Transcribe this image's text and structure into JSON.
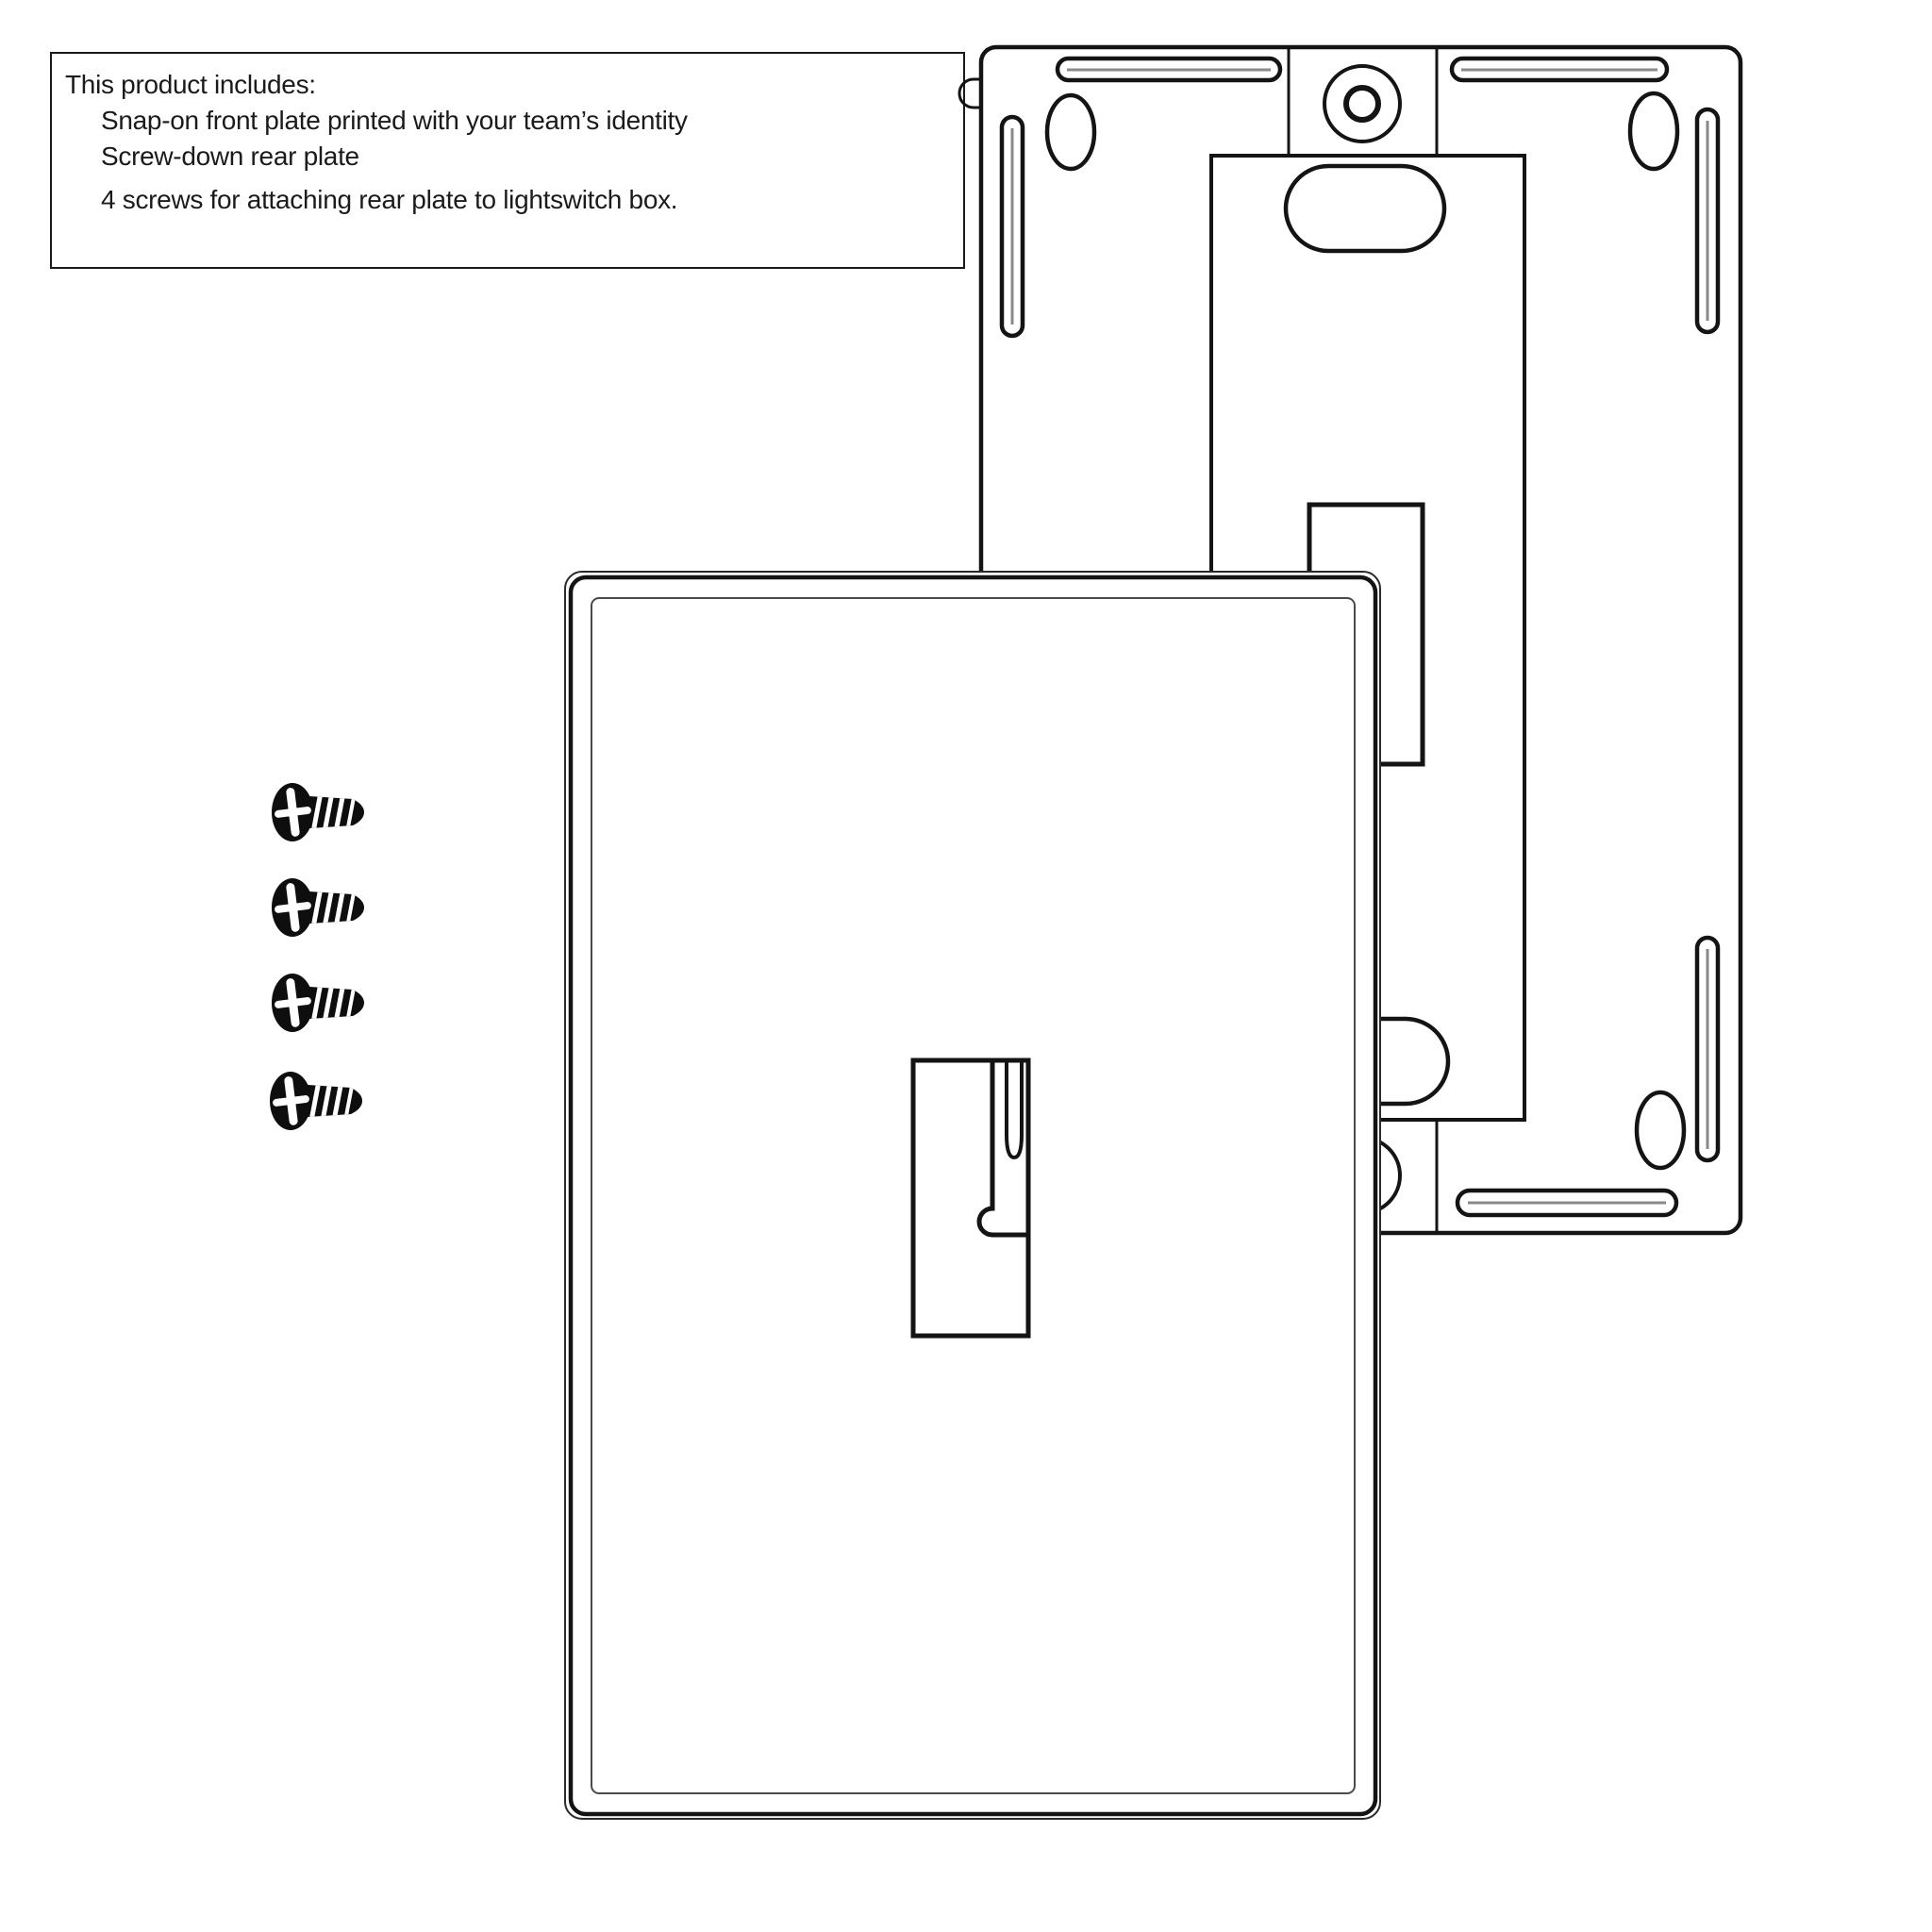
{
  "page": {
    "background_color": "#ffffff",
    "line_color": "#141414",
    "description": "Line-art product diagram of a lightswitch wall plate kit"
  },
  "info_box": {
    "title": "This product includes:",
    "items": [
      "Snap-on front plate printed with your team’s identity",
      "Screw-down rear plate",
      "4 screws for attaching rear plate to lightswitch box."
    ]
  },
  "diagram": {
    "front_plate": "snap-on front plate with toggle switch opening",
    "rear_plate": "screw-down rear plate with mounting slots and screw holes",
    "screw_count": 4
  }
}
